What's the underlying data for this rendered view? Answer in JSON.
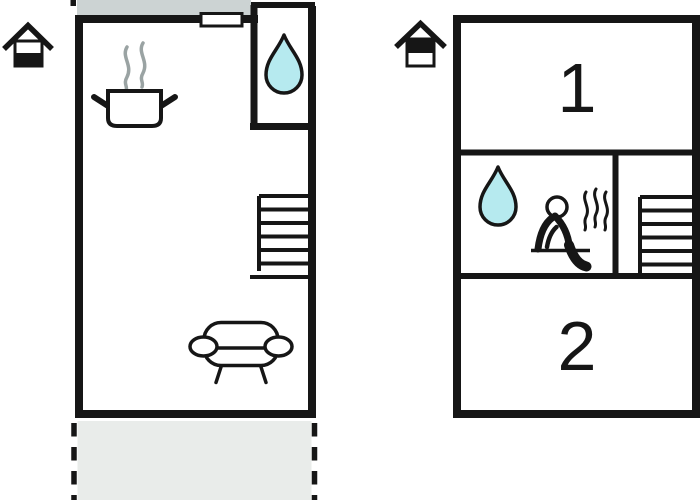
{
  "diagram": {
    "type": "floor-plan",
    "colors": {
      "line": "#161616",
      "water_drop_fill": "#b6eaef",
      "steam_gray": "#9aa3a3",
      "upper_strip_gray": "#ccd3d3",
      "terrace_gray": "#e9ecea",
      "background": "#ffffff"
    },
    "plans": {
      "ground_floor": {
        "level_icon": "house-lower-level-highlighted-icon",
        "features": [
          {
            "name": "entrance-door",
            "icon": "door-icon"
          },
          {
            "name": "kitchen",
            "icon": "cooking-pot-icon"
          },
          {
            "name": "bathroom",
            "icon": "water-drop-icon"
          },
          {
            "name": "staircase",
            "icon": "stairs-icon"
          },
          {
            "name": "living-area",
            "icon": "sofa-icon"
          },
          {
            "name": "terrace",
            "icon": "dashed-terrace-area"
          }
        ]
      },
      "first_floor": {
        "level_icon": "house-upper-level-highlighted-icon",
        "rooms": [
          {
            "label": "1"
          },
          {
            "label": "2"
          }
        ],
        "features": [
          {
            "name": "bathroom",
            "icon": "water-drop-icon"
          },
          {
            "name": "sauna",
            "icon": "sauna-person-icon"
          },
          {
            "name": "staircase",
            "icon": "stairs-icon"
          }
        ]
      }
    }
  }
}
